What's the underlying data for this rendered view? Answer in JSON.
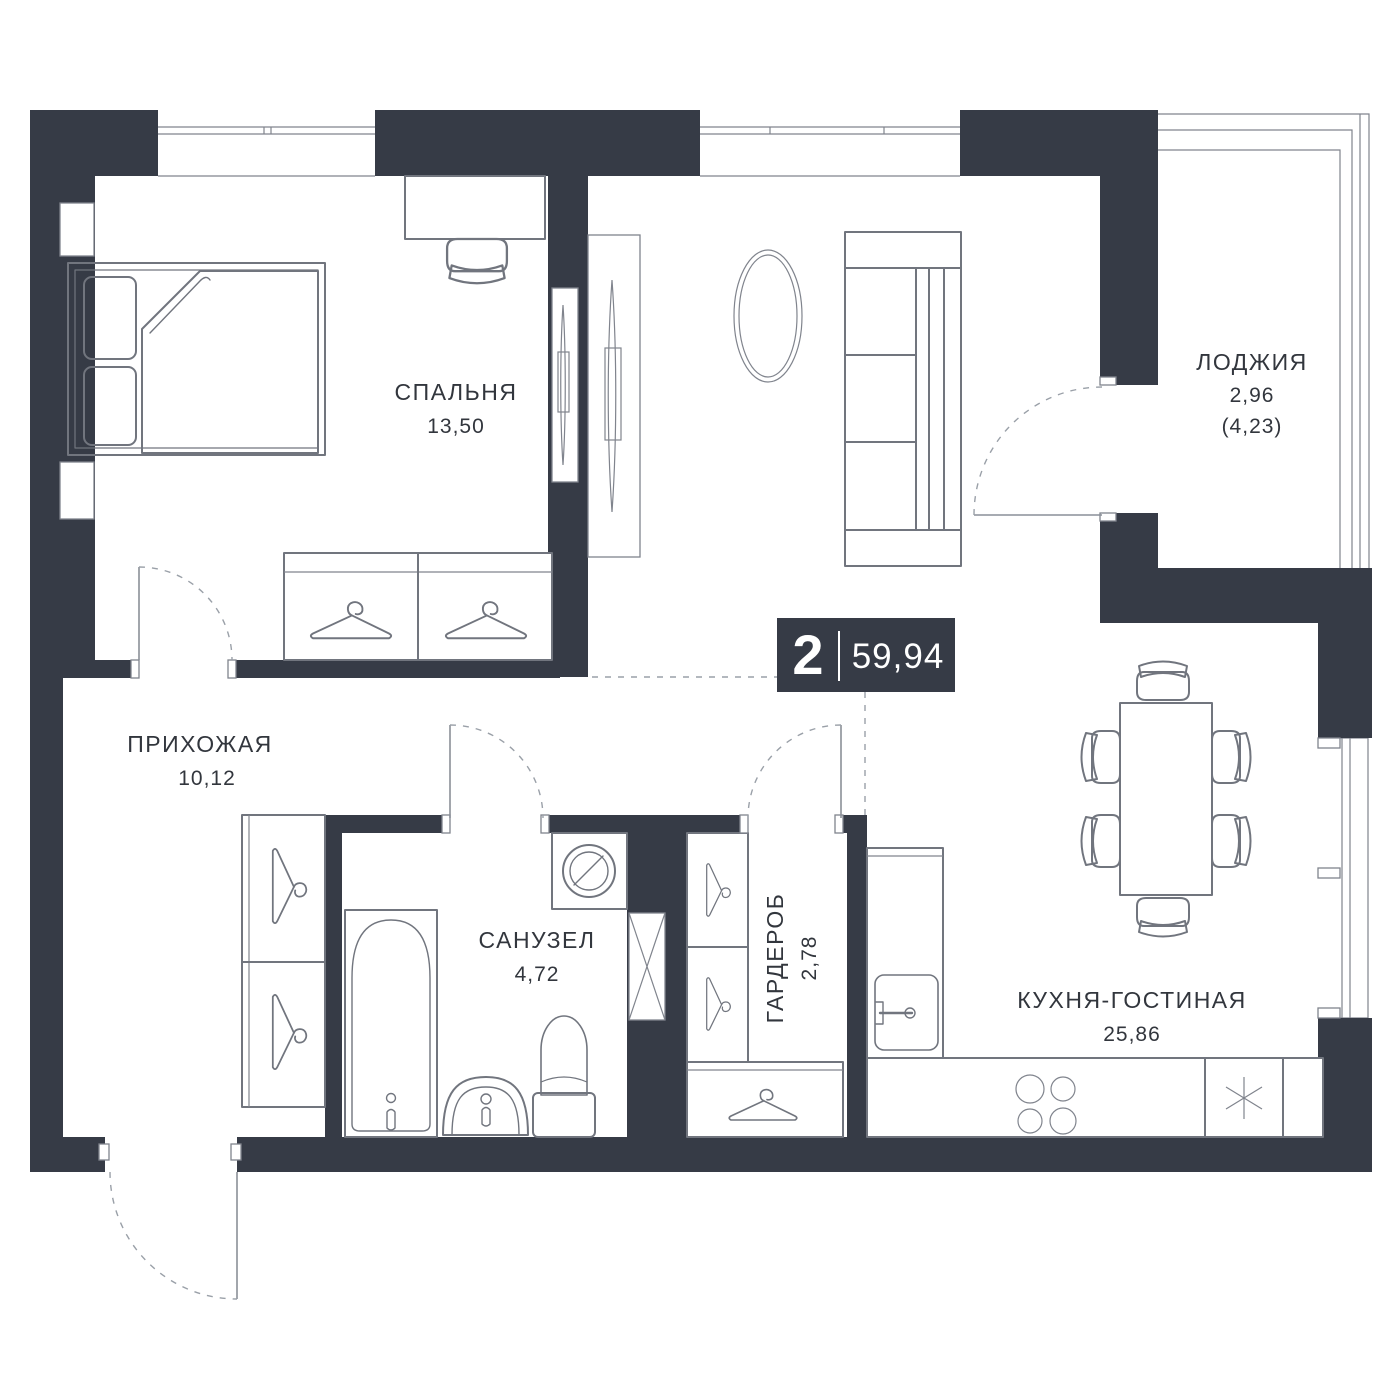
{
  "badge": {
    "rooms": "2",
    "area": "59,94"
  },
  "rooms": [
    {
      "id": "bedroom",
      "name": "СПАЛЬНЯ",
      "area": "13,50"
    },
    {
      "id": "loggia",
      "name": "ЛОДЖИЯ",
      "area": "2,96",
      "area_alt": "(4,23)"
    },
    {
      "id": "hallway",
      "name": "ПРИХОЖАЯ",
      "area": "10,12"
    },
    {
      "id": "bathroom",
      "name": "САНУЗЕЛ",
      "area": "4,72"
    },
    {
      "id": "wardrobe",
      "name": "ГАРДЕРОБ",
      "area": "2,78"
    },
    {
      "id": "kitchen-living",
      "name": "КУХНЯ-ГОСТИНАЯ",
      "area": "25,86"
    }
  ],
  "colors": {
    "wall": "#363B46",
    "line": "#71757E",
    "text": "#32363D",
    "dash": "#9AA0A8",
    "badge_bg": "#363B46",
    "badge_text": "#FFFFFF",
    "bg": "#FFFFFF"
  },
  "icons": {
    "hanger": "hanger-icon",
    "fridge": "snowflake-icon",
    "stove": "burner-rings-icon",
    "vent_shaft": "crossed-box-icon"
  }
}
